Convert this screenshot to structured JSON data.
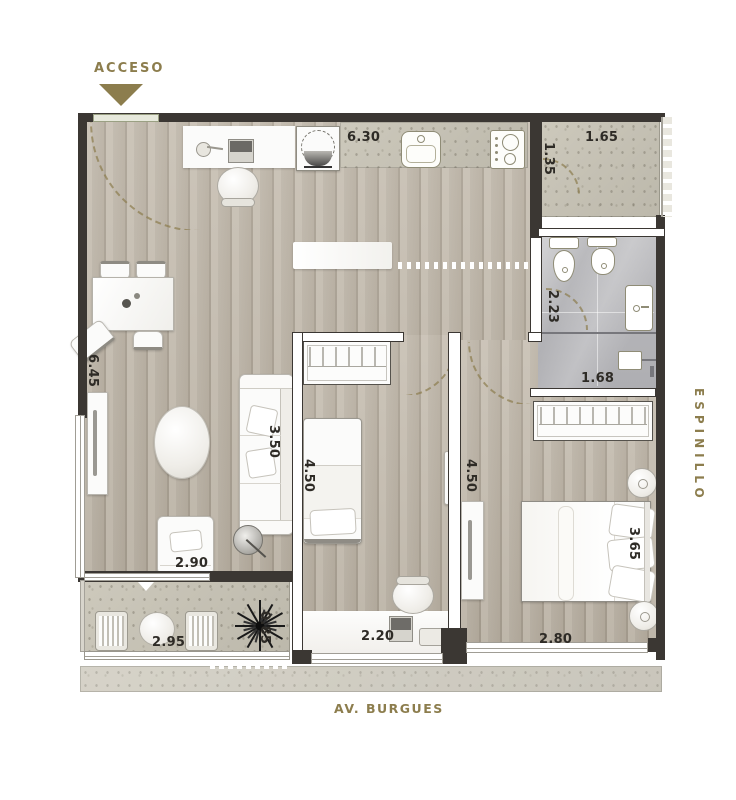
{
  "labels": {
    "access": "ACCESO",
    "street_right": "ESPINILLO",
    "street_bottom": "AV. BURGUES"
  },
  "dimensions": {
    "kitchen_counter": "6.30",
    "terrace_width": "1.65",
    "terrace_depth": "1.35",
    "bathroom_depth": "2.23",
    "bathroom_width": "1.68",
    "living_length": "6.45",
    "sofa_length": "3.50",
    "bedroom1_length": "4.50",
    "bedroom2_length": "4.50",
    "lounge_width": "2.90",
    "bed_width": "3.65",
    "bedroom2_width": "2.80",
    "balcony_width": "2.95",
    "planter_width": "0.85",
    "desk_width": "2.20"
  },
  "colors": {
    "accent_olive": "#8C7D4D",
    "wall": "#3B3733",
    "wood_floor": "#BDB4A7",
    "concrete": "#C6C2B5",
    "marble": "#B6B6B9",
    "dimension_text": "#2E2B26"
  }
}
